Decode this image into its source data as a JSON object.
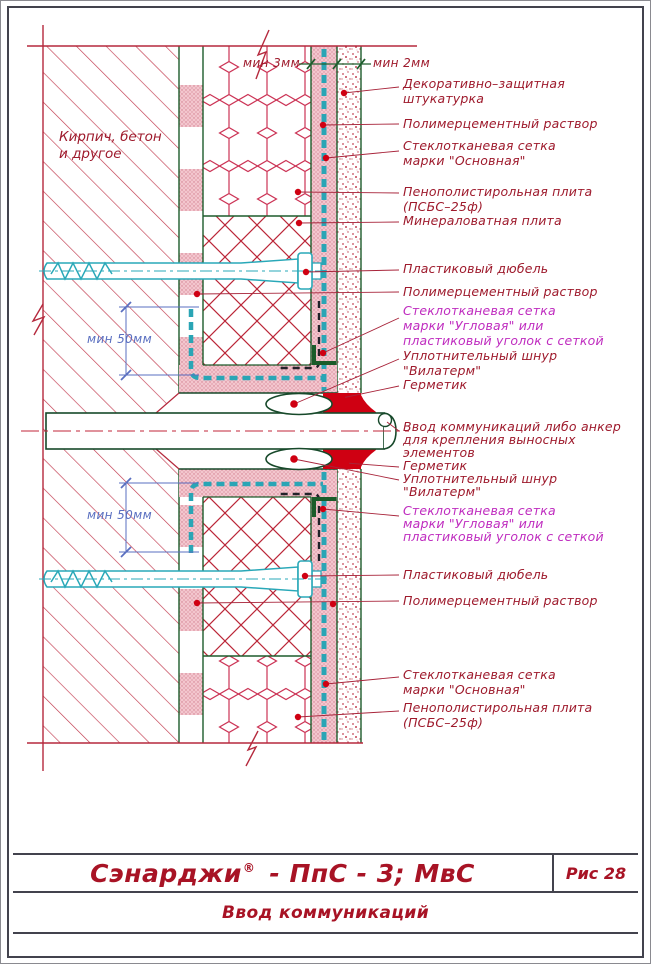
{
  "title_block": {
    "product": "Сэнарджи",
    "registered_mark": "®",
    "product_suffix": "- ПпС - 3; МвС",
    "figure": "Рис 28",
    "caption": "Ввод коммуникаций"
  },
  "wall_note": {
    "lines": [
      "Кирпич, бетон",
      "и другое"
    ]
  },
  "dimensions": {
    "min_3mm": "мин 3мм",
    "min_2mm": "мин 2мм",
    "min_50mm": "мин 50мм"
  },
  "labels": {
    "l1": {
      "lines": [
        "Декоративно–защитная",
        "штукатурка"
      ]
    },
    "l2": {
      "lines": [
        "Полимерцементный  раствор"
      ]
    },
    "l3": {
      "lines": [
        "Стеклотканевая  сетка",
        "марки  \"Основная\""
      ]
    },
    "l4": {
      "lines": [
        "Пенополистирольная  плита",
        "(ПСБС–25ф)"
      ]
    },
    "l5": {
      "lines": [
        "Минераловатная  плита"
      ]
    },
    "l6": {
      "lines": [
        "Пластиковый  дюбель"
      ]
    },
    "l7": {
      "lines": [
        "Полимерцементный  раствор"
      ]
    },
    "l8": {
      "lines": [
        "Стеклотканевая  сетка",
        "марки  \"Угловая\"  или",
        "пластиковый  уголок  с  сеткой"
      ]
    },
    "l9": {
      "lines": [
        "Уплотнительный  шнур",
        "\"Вилатерм\""
      ]
    },
    "l10": {
      "lines": [
        "Герметик"
      ]
    },
    "l11": {
      "lines": [
        "Ввод  коммуникаций  либо  анкер",
        "для  крепления  выносных",
        "элементов"
      ]
    },
    "l12": {
      "lines": [
        "Герметик"
      ]
    },
    "l13": {
      "lines": [
        "Уплотнительный  шнур",
        "\"Вилатерм\""
      ]
    },
    "l14": {
      "lines": [
        "Стеклотканевая  сетка",
        "марки  \"Угловая\"  или",
        "пластиковый  уголок  с  сеткой"
      ]
    },
    "l15": {
      "lines": [
        "Пластиковый  дюбель"
      ]
    },
    "l16": {
      "lines": [
        "Полимерцементный  раствор"
      ]
    },
    "l17": {
      "lines": [
        "Стеклотканевая  сетка",
        "марки  \"Основная\""
      ]
    },
    "l18": {
      "lines": [
        "Пенополистирольная  плита",
        "(ПСБС–25ф)"
      ]
    }
  },
  "colors": {
    "label_red": "#9e1a2c",
    "label_magenta": "#bf2cbf",
    "title_red": "#a81325",
    "hatch_red": "#c23a4e",
    "layer_green": "#1d5c2c",
    "mesh_teal": "#2aa5b5",
    "dimension_blue": "#5a6fc0",
    "sealant_red": "#cf0012",
    "frame_gray": "#43434d"
  }
}
